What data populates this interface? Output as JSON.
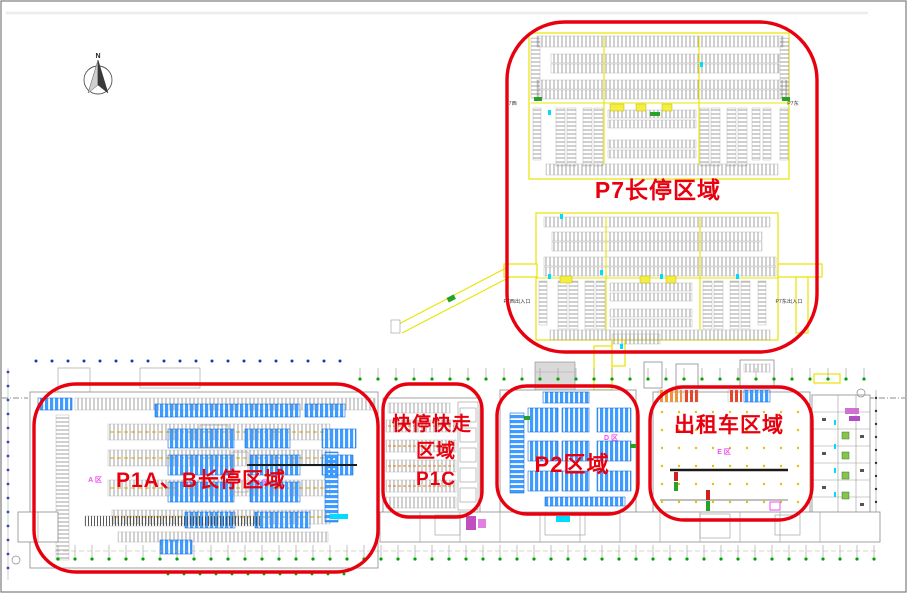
{
  "colors": {
    "annotation_red": "#e8000f",
    "zone_label_magenta": "#f24df2",
    "stall_blue": "#3e9bff",
    "lane_yellow": "#e8e400",
    "hatch_gray": "#777777",
    "grid_green": "#00a300",
    "grid_blue": "#2233bb",
    "cyan_accent": "#00dcff",
    "taxi_stall_red": "#e8442a"
  },
  "compass": {
    "label": "N"
  },
  "zones": {
    "p7": {
      "label": "P7长停区域"
    },
    "p1ab": {
      "label": "P1A、B长停区域"
    },
    "p1c": {
      "line1": "快停快走",
      "line2": "区域",
      "line3": "P1C"
    },
    "p2": {
      "label": "P2区域"
    },
    "taxi": {
      "label": "出租车区域"
    }
  },
  "plan_labels": {
    "p7_west": "P7西",
    "p7_east": "P7东",
    "p7_west_entrance": "P7西出入口",
    "p7_east_entrance": "P7东出入口",
    "area_a": "A 区",
    "area_b": "B 区",
    "area_d": "D 区",
    "area_e": "E 区"
  }
}
